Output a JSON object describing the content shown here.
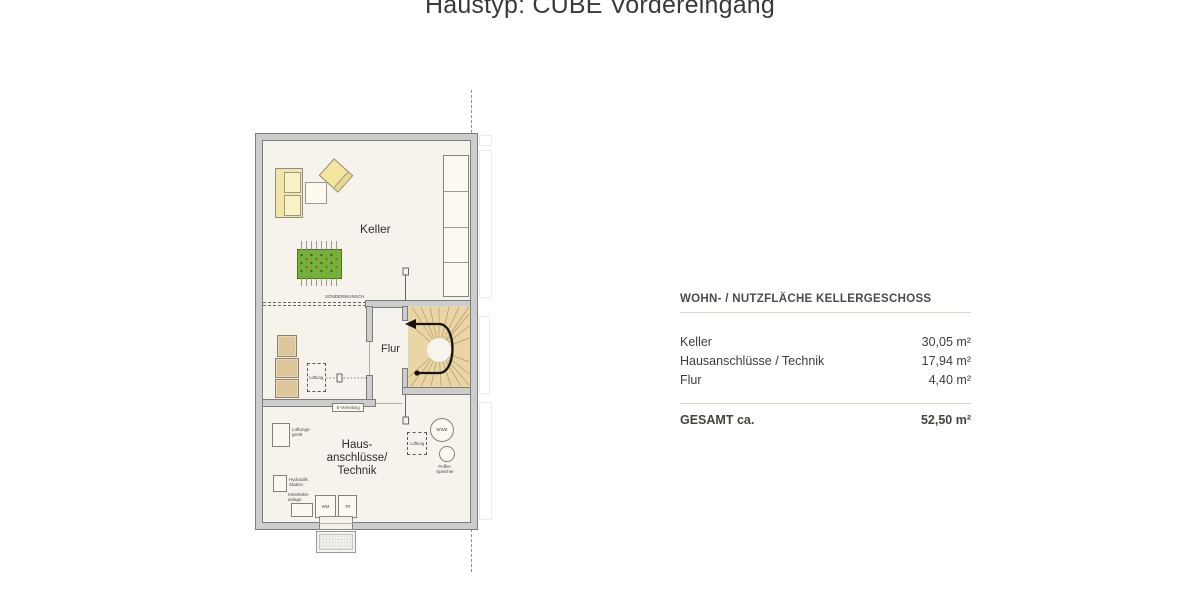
{
  "title": "Haustyp: CUBE Vordereingang",
  "floorplan": {
    "room_labels": {
      "keller": "Keller",
      "flur": "Flur",
      "technik_lines": [
        "Haus-",
        "anschlüsse/",
        "Technik"
      ]
    },
    "annotations": {
      "sonderwunsch": "SONDERWUNSCH",
      "e_verteilung": "E-Verteilung",
      "lueftung": "Lüftung",
      "lueftungsgeraet_lines": [
        "Lüftungs-",
        "gerät"
      ],
      "hydraulik_lines": [
        "Hydraulik",
        "Station"
      ],
      "kleinhebe_lines": [
        "Kleinhebe-",
        "anlage"
      ],
      "wm": "WM",
      "tr": "TR",
      "wwb": "WWB",
      "puffer_lines": [
        "Puffer-",
        "Speicher"
      ]
    }
  },
  "area_table": {
    "header": "WOHN- / NUTZFLÄCHE KELLERGESCHOSS",
    "rows": [
      {
        "label": "Keller",
        "value": "30,05 m²"
      },
      {
        "label": "Hausanschlüsse / Technik",
        "value": "17,94 m²"
      },
      {
        "label": "Flur",
        "value": "4,40 m²"
      }
    ],
    "total": {
      "label": "GESAMT ca.",
      "value": "52,50 m²"
    }
  },
  "colors": {
    "wall": "#cdcdcd",
    "floor": "#f6f3ec",
    "stair_wood": "#e9d5a5",
    "furniture_yellow": "#f1e5aa",
    "kicker_green": "#72b52e",
    "table_rule": "#dcd8c8",
    "text": "#3c3c3c"
  }
}
